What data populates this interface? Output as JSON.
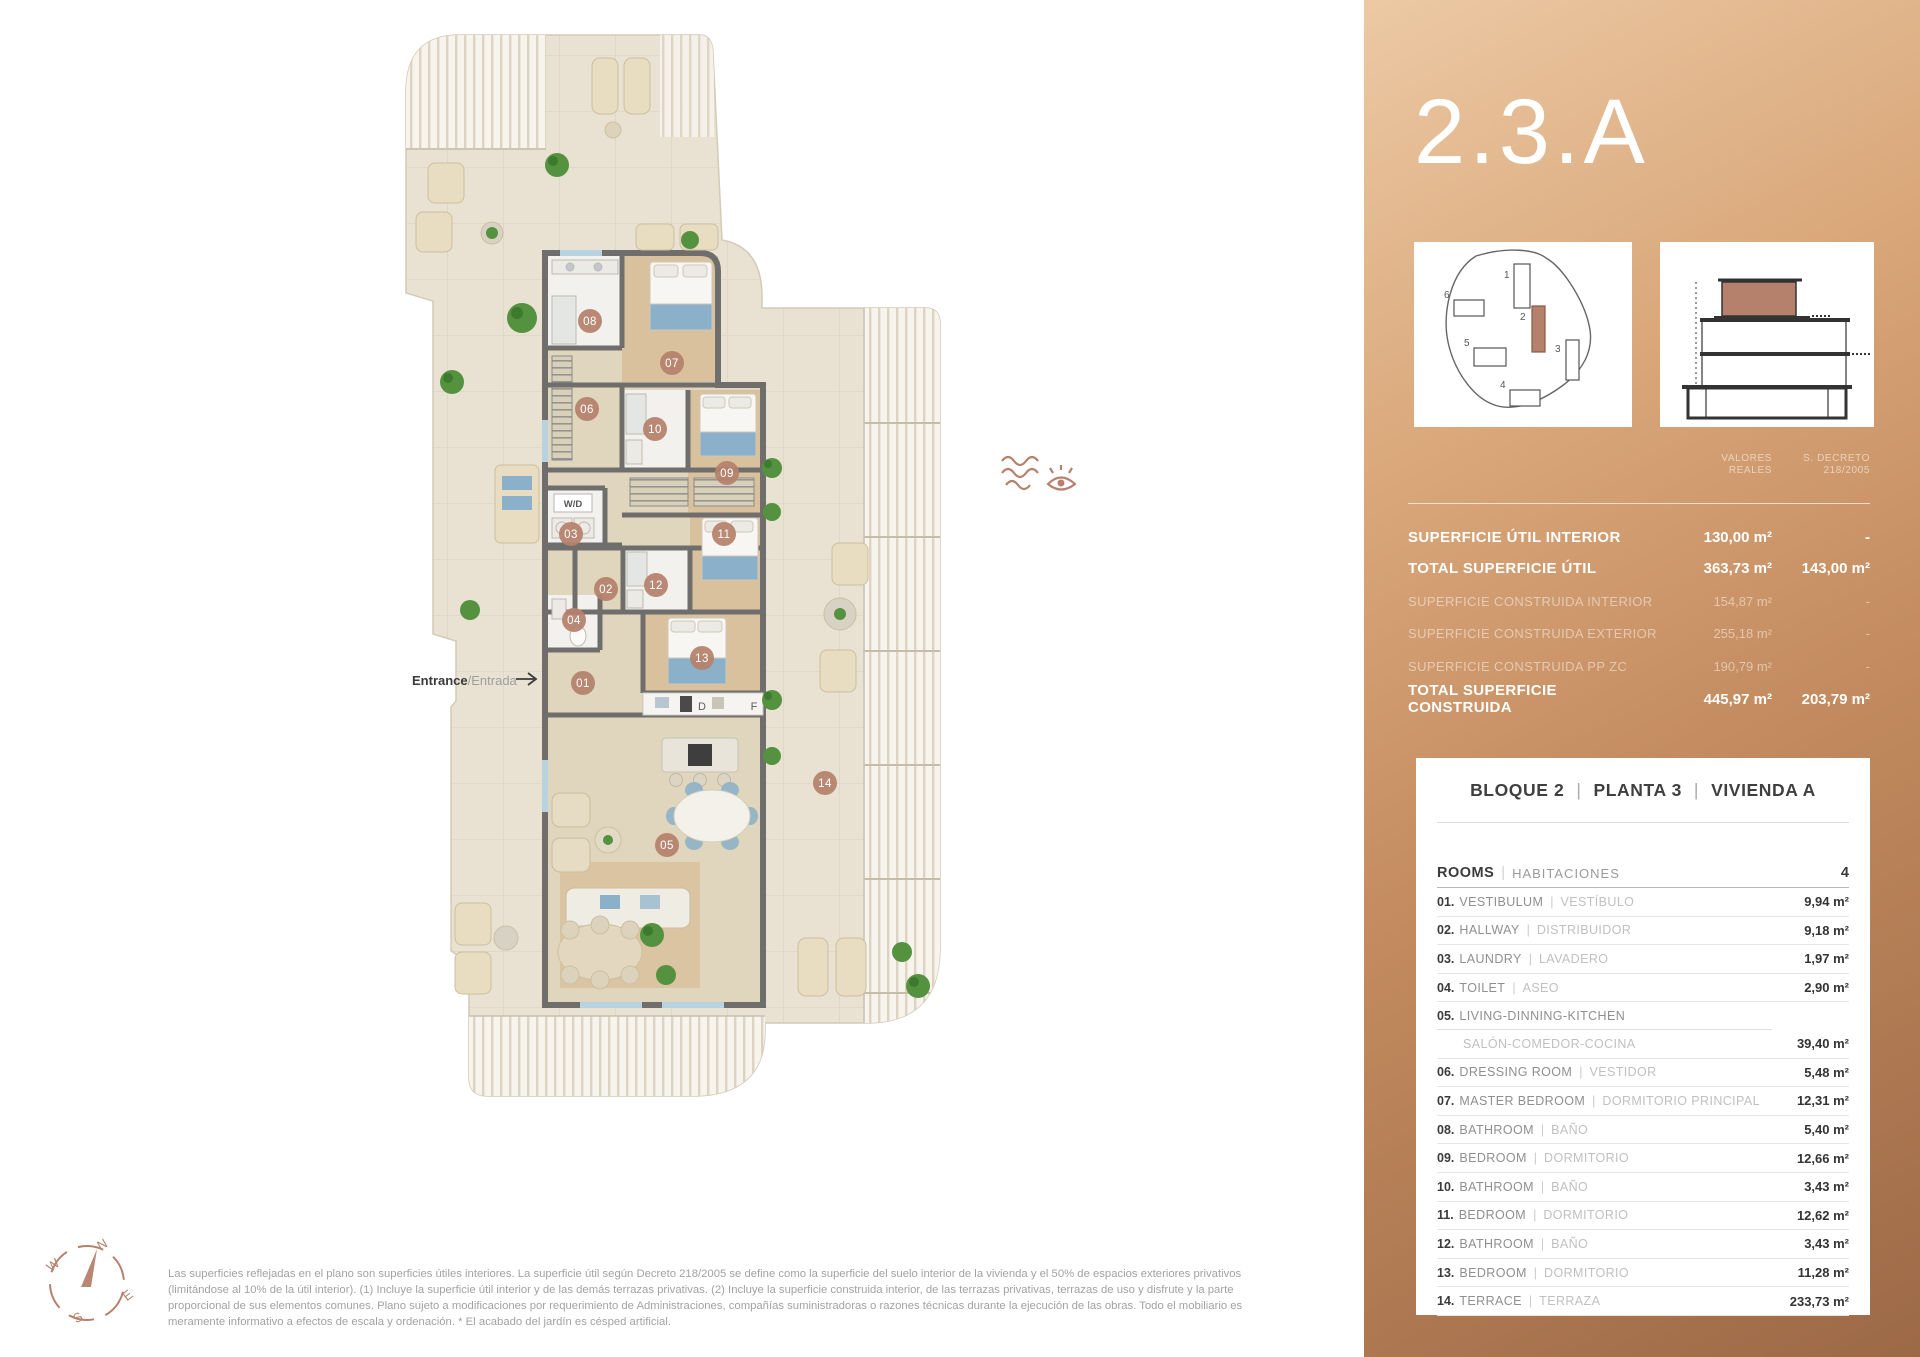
{
  "theme": {
    "accent": "#b5816c",
    "panel_top": "#ecc9a4",
    "panel_bottom": "#9c6947",
    "wall": "#6f6e6c",
    "floor_beige": "#e0d5bd",
    "floor_wood": "#d9c19e",
    "terrace": "#e9e2d3",
    "bed_blue": "#8bb0ca",
    "plant_green": "#55923f"
  },
  "plan": {
    "entrance": {
      "label_en": "Entrance",
      "label_es": "/Entrada"
    },
    "wd_label": "W/D",
    "kitchen_letters": {
      "d": "D",
      "f": "F"
    },
    "markers": [
      {
        "label": "01"
      },
      {
        "label": "02"
      },
      {
        "label": "03"
      },
      {
        "label": "04"
      },
      {
        "label": "05"
      },
      {
        "label": "06"
      },
      {
        "label": "07"
      },
      {
        "label": "08"
      },
      {
        "label": "09"
      },
      {
        "label": "10"
      },
      {
        "label": "11"
      },
      {
        "label": "12"
      },
      {
        "label": "13"
      },
      {
        "label": "14"
      }
    ]
  },
  "compass": {
    "n": "N",
    "s": "S",
    "e": "E",
    "w": "W"
  },
  "disclaimer": {
    "lines": [
      "Las superficies reflejadas en el plano son superficies útiles interiores. La superficie útil según Decreto 218/2005 se define como la superficie del suelo interior de la vivienda y el 50% de espacios exteriores privativos",
      "(limitándose al 10% de la útil interior). (1) Incluye la superficie útil interior y de las demás terrazas privativas. (2) Incluye la superficie construida interior, de las terrazas privativas, terrazas de uso y disfrute y la parte",
      "proporcional de sus elementos comunes. Plano sujeto a modificaciones por requerimiento de Administraciones, compañías suministradoras o razones técnicas durante la ejecución de las obras. Todo el mobiliario es",
      "meramente informativo a efectos de escala y ordenación. * El acabado del jardín es césped artificial."
    ]
  },
  "sidebar": {
    "title": "2.3.A",
    "site_numbers": [
      "1",
      "2",
      "3",
      "4",
      "5",
      "6"
    ],
    "surface_table": {
      "col1_header": [
        "VALORES",
        "REALES"
      ],
      "col2_header": [
        "S. DECRETO",
        "218/2005"
      ],
      "rows": [
        {
          "label": "SUPERFICIE ÚTIL INTERIOR",
          "real": "130,00 m²",
          "decreto": "-"
        },
        {
          "label": "TOTAL SUPERFICIE ÚTIL",
          "real": "363,73 m²",
          "decreto": "143,00 m²"
        },
        {
          "label": "SUPERFICIE CONSTRUIDA INTERIOR",
          "real": "154,87 m²",
          "decreto": "-"
        },
        {
          "label": "SUPERFICIE CONSTRUIDA EXTERIOR",
          "real": "255,18 m²",
          "decreto": "-"
        },
        {
          "label": "SUPERFICIE CONSTRUIDA PP ZC",
          "real": "190,79 m²",
          "decreto": "-"
        },
        {
          "label": "TOTAL SUPERFICIE CONSTRUIDA",
          "real": "445,97 m²",
          "decreto": "203,79 m²"
        }
      ]
    },
    "unit_card": {
      "heading_parts": [
        "BLOQUE 2",
        "PLANTA 3",
        "VIVIENDA A"
      ],
      "pipe": "|",
      "rooms_header": {
        "en": "ROOMS",
        "es": "HABITACIONES",
        "count": "4"
      },
      "rooms": [
        {
          "num": "01.",
          "en": "VESTIBULUM",
          "es": "VESTÍBULO",
          "area": "9,94 m²"
        },
        {
          "num": "02.",
          "en": "HALLWAY",
          "es": "DISTRIBUIDOR",
          "area": "9,18 m²"
        },
        {
          "num": "03.",
          "en": "LAUNDRY",
          "es": "LAVADERO",
          "area": "1,97 m²"
        },
        {
          "num": "04.",
          "en": "TOILET",
          "es": "ASEO",
          "area": "2,90 m²"
        },
        {
          "num": "05.",
          "en": "LIVING-DINNING-KITCHEN",
          "es": "SALÓN-COMEDOR-COCINA",
          "area": "39,40 m²"
        },
        {
          "num": "06.",
          "en": "DRESSING ROOM",
          "es": "VESTIDOR",
          "area": "5,48 m²"
        },
        {
          "num": "07.",
          "en": "MASTER BEDROOM",
          "es": "DORMITORIO PRINCIPAL",
          "area": "12,31 m²"
        },
        {
          "num": "08.",
          "en": "BATHROOM",
          "es": "BAÑO",
          "area": "5,40 m²"
        },
        {
          "num": "09.",
          "en": "BEDROOM",
          "es": "DORMITORIO",
          "area": "12,66 m²"
        },
        {
          "num": "10.",
          "en": "BATHROOM",
          "es": "BAÑO",
          "area": "3,43 m²"
        },
        {
          "num": "11.",
          "en": "BEDROOM",
          "es": "DORMITORIO",
          "area": "12,62 m²"
        },
        {
          "num": "12.",
          "en": "BATHROOM",
          "es": "BAÑO",
          "area": "3,43 m²"
        },
        {
          "num": "13.",
          "en": "BEDROOM",
          "es": "DORMITORIO",
          "area": "11,28 m²"
        },
        {
          "num": "14.",
          "en": "TERRACE",
          "es": "TERRAZA",
          "area": "233,73 m²"
        }
      ]
    }
  }
}
